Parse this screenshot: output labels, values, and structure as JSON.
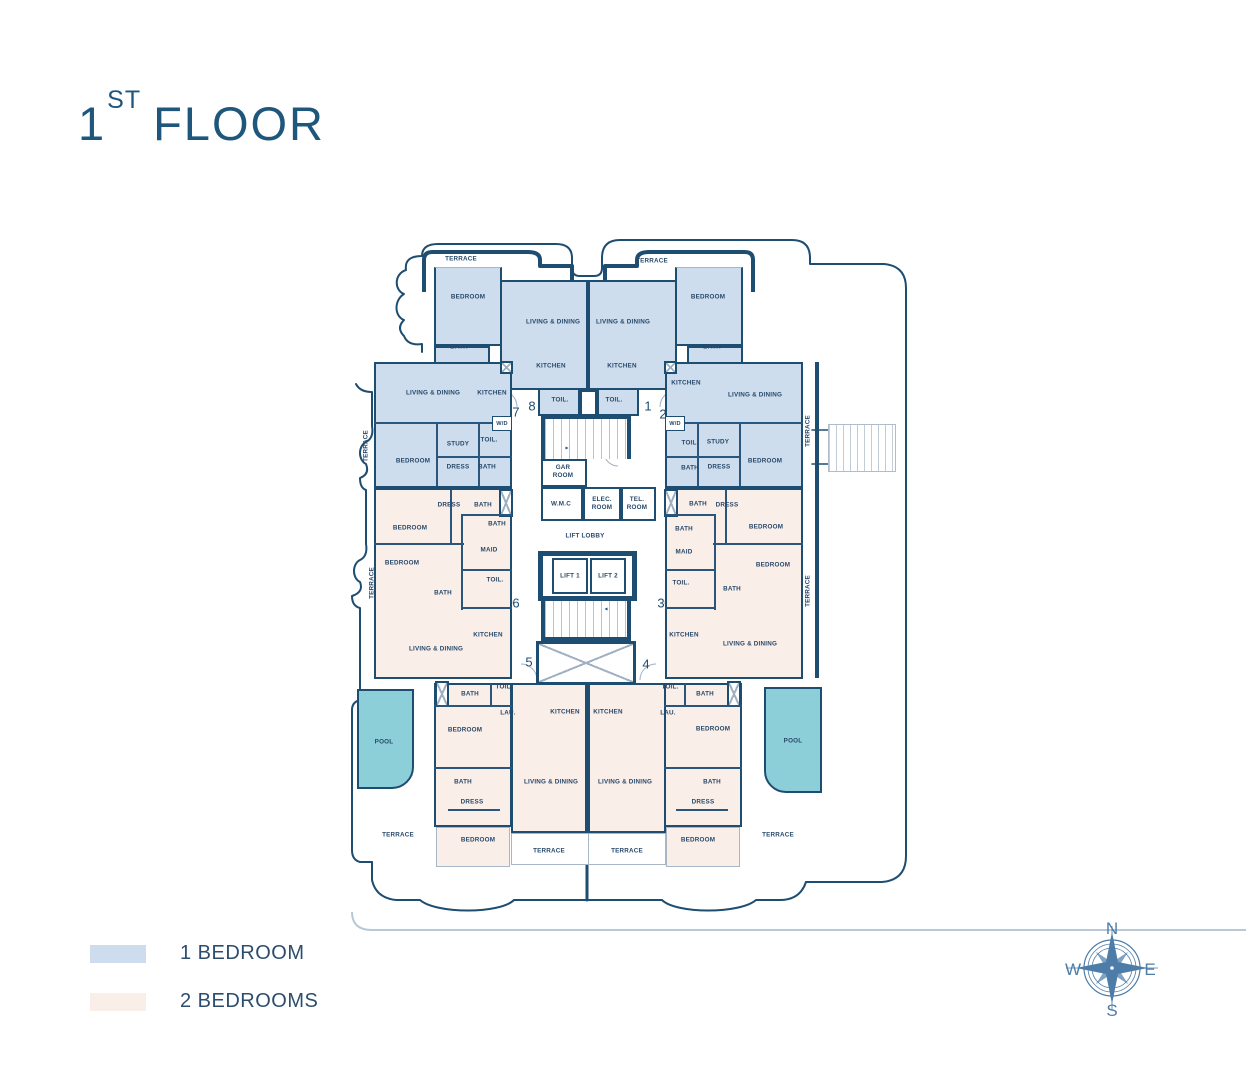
{
  "title": {
    "number": "1",
    "ordinal": "ST",
    "word": "FLOOR"
  },
  "legend": {
    "items": [
      {
        "label": "1 BEDROOM",
        "color": "#cddded"
      },
      {
        "label": "2 BEDROOMS",
        "color": "#faeee8"
      }
    ]
  },
  "compass": {
    "north": "N",
    "west": "W",
    "east": "E",
    "south": "S"
  },
  "labels": {
    "terrace": "TERRACE",
    "bedroom": "BEDROOM",
    "bath": "BATH",
    "living_dining": "LIVING & DINING",
    "kitchen": "KITCHEN",
    "toilet": "TOIL.",
    "study": "STUDY",
    "dress": "DRESS",
    "maid": "MAID",
    "laundry": "LAU.",
    "washer_dryer": "W/D",
    "pool": "POOL",
    "gar_room": "GAR ROOM",
    "wmc": "W.M.C",
    "elec_room": "ELEC. ROOM",
    "tel_room": "TEL. ROOM",
    "lift_lobby": "LIFT LOBBY",
    "lift_1": "LIFT 1",
    "lift_2": "LIFT 2"
  },
  "unit_numbers": {
    "u1": "1",
    "u2": "2",
    "u3": "3",
    "u4": "4",
    "u5": "5",
    "u6": "6",
    "u7": "7",
    "u8": "8"
  },
  "colors": {
    "one_bedroom": "#cddded",
    "two_bedrooms": "#faeee8",
    "pool": "#8ccfd9",
    "wall": "#1e4d72",
    "text": "#27496b",
    "title": "#1f577c",
    "compass": "#4d7ca8"
  }
}
